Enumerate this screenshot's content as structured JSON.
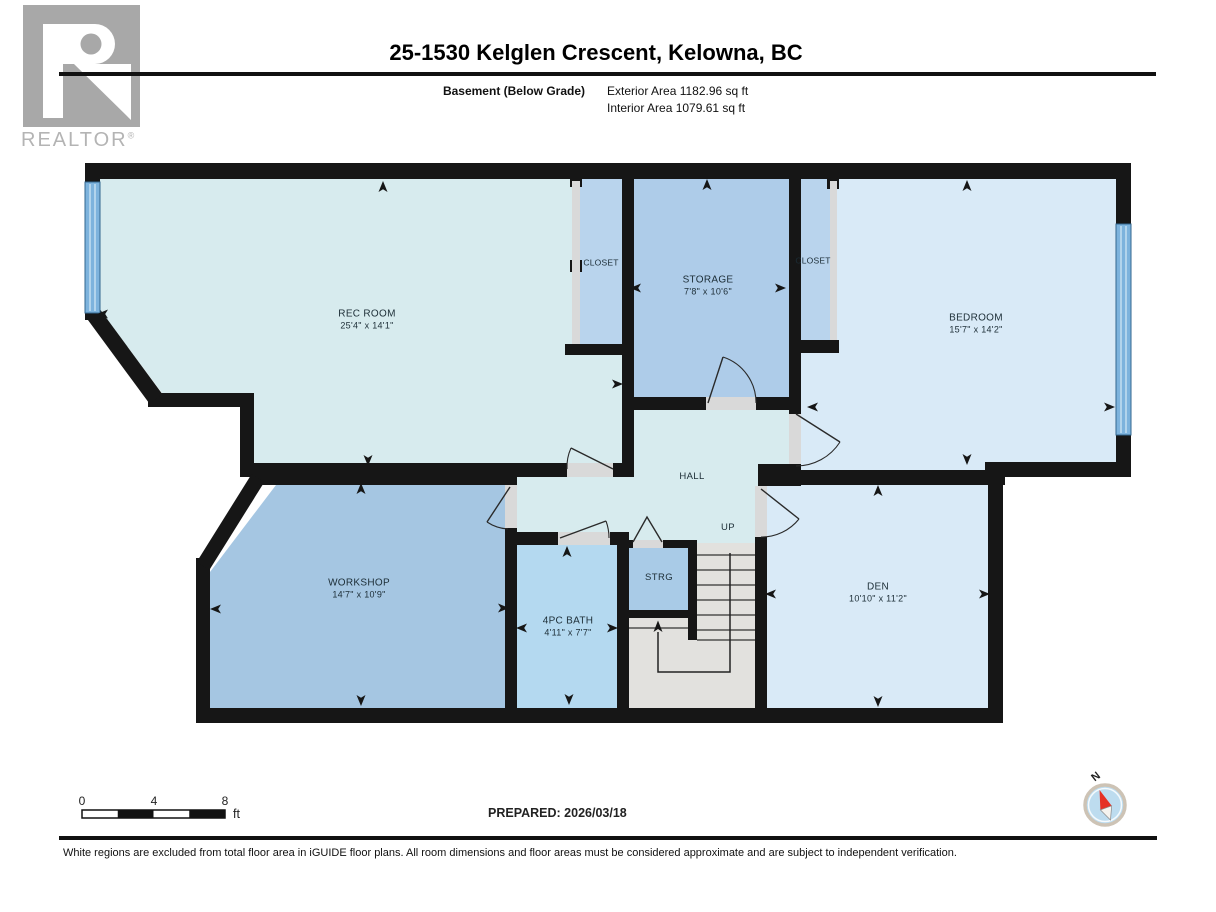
{
  "header": {
    "title": "25-1530 Kelglen Crescent, Kelowna, BC",
    "floor_label": "Basement (Below Grade)",
    "exterior_area": "Exterior Area 1182.96 sq ft",
    "interior_area": "Interior Area 1079.61 sq ft"
  },
  "logo": {
    "text": "REALTOR",
    "registered": "®"
  },
  "rooms": {
    "rec": {
      "name": "REC ROOM",
      "dims": "25'4\" x 14'1\""
    },
    "storage": {
      "name": "STORAGE",
      "dims": "7'8\" x 10'6\""
    },
    "bedroom": {
      "name": "BEDROOM",
      "dims": "15'7\" x 14'2\""
    },
    "closet_left": {
      "name": "CLOSET"
    },
    "closet_right": {
      "name": "CLOSET"
    },
    "hall": {
      "name": "HALL"
    },
    "workshop": {
      "name": "WORKSHOP",
      "dims": "14'7\" x 10'9\""
    },
    "bath": {
      "name": "4PC BATH",
      "dims": "4'11\" x 7'7\""
    },
    "strg": {
      "name": "STRG"
    },
    "den": {
      "name": "DEN",
      "dims": "10'10\" x 11'2\""
    }
  },
  "stairs": {
    "up_label": "UP"
  },
  "scale_bar": {
    "tick_0": "0",
    "tick_4": "4",
    "tick_8": "8",
    "unit": "ft"
  },
  "footer": {
    "prepared": "PREPARED: 2026/03/18",
    "disclaimer": "White regions are excluded from total floor area in iGUIDE floor plans. All room dimensions and floor areas must be considered approximate and are subject to independent verification."
  },
  "compass": {
    "north_label": "N"
  },
  "colors": {
    "wall": "#161616",
    "room_pale_cyan": "#d7ebee",
    "room_light_blue": "#d9eaf7",
    "room_medium_blue": "#a5c6e2",
    "room_storage_blue": "#aecce9",
    "room_closet_blue": "#b9d4ed",
    "room_bath_blue": "#b4d9f0",
    "stairs_gray": "#e2e1de",
    "door_gap_gray": "#d9d9d9",
    "window_blue": "#7db3dd",
    "compass_red": "#e53125",
    "logo_gray": "#a8a8a8"
  }
}
